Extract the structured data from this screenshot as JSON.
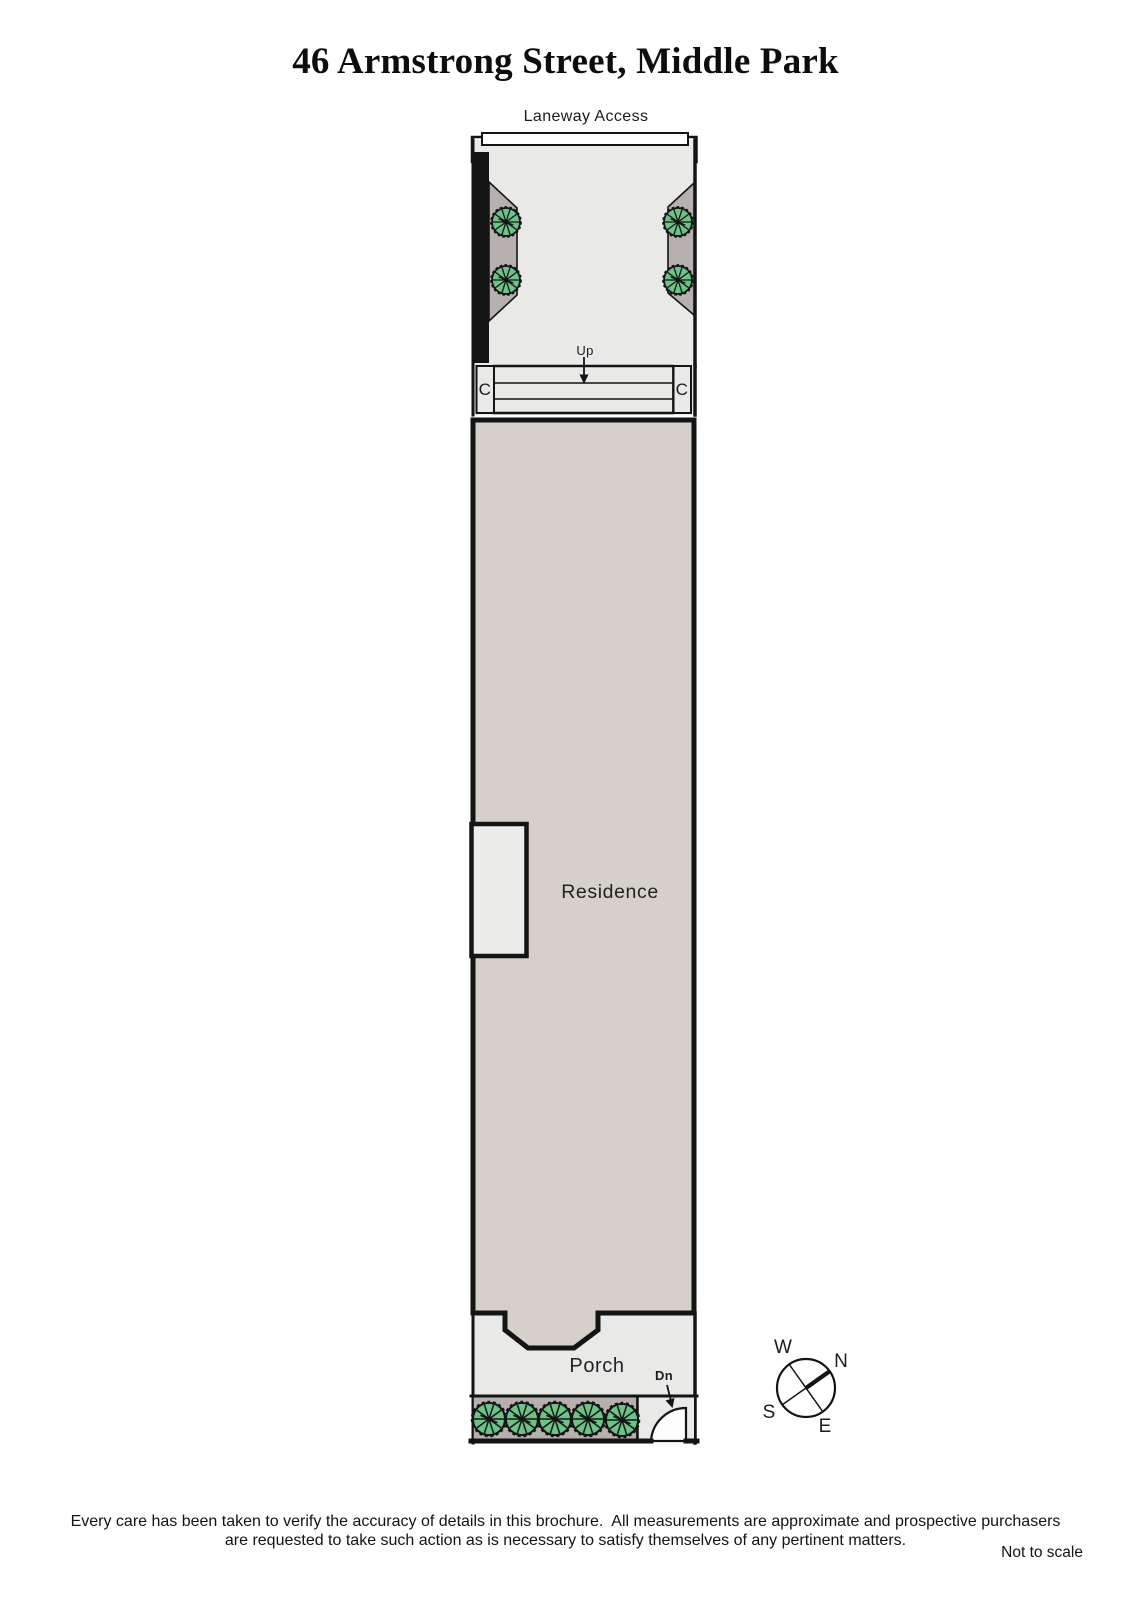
{
  "title": "46 Armstrong Street, Middle Park",
  "plan": {
    "laneway_label": "Laneway Access",
    "up_label": "Up",
    "cupboard_left_label": "C",
    "cupboard_right_label": "C",
    "residence_label": "Residence",
    "porch_label": "Porch",
    "down_label": "Dn"
  },
  "compass": {
    "north": "N",
    "south": "S",
    "east": "E",
    "west": "W"
  },
  "footer": {
    "disclaimer_line1": "Every care has been taken to verify the accuracy of details in this brochure.  All measurements are approximate and prospective purchasers",
    "disclaimer_line2": "are requested to take such action as is necessary to satisfy themselves of any pertinent matters.",
    "scale_note": "Not to scale"
  },
  "colors": {
    "ink": "#141414",
    "residence_fill": "#d5d1ca",
    "paving_fill": "#e9e9e7",
    "garden_bed_fill": "#b6b1ae",
    "tree_green": "#6cc287",
    "bay_fill": "#ececea",
    "laneway_fill": "#ffffff",
    "door_leaf_fill": "#fdfdfd"
  }
}
